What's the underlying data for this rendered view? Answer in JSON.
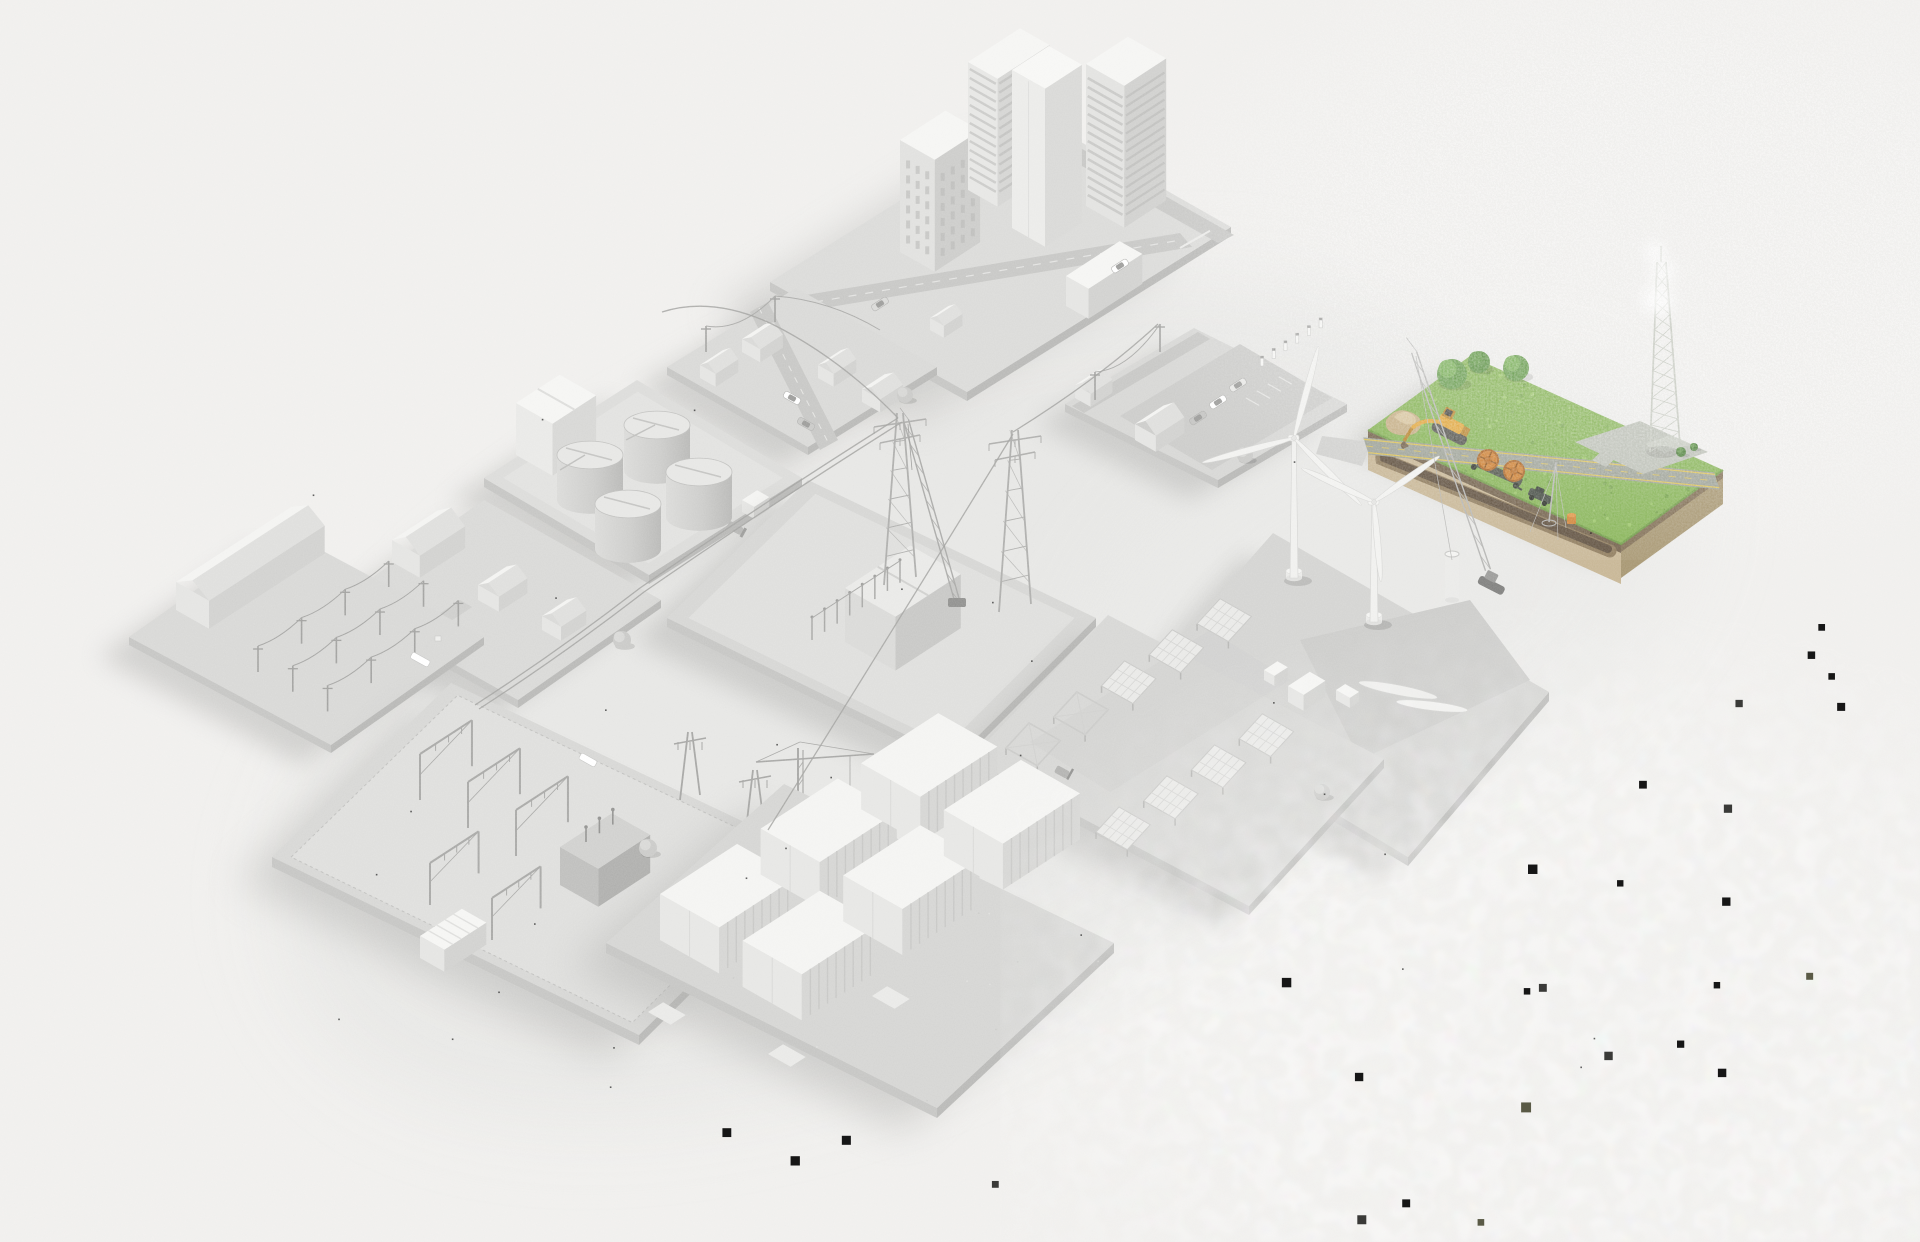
{
  "scene": {
    "title": "Isometric energy infrastructure illustration",
    "description": "3D isometric diorama of twelve city and energy tiles rendered in grayscale, with one highlighted green construction tile where an excavator digs an underground cable trench beside a country road and a lattice tower.",
    "width": 1920,
    "height": 1242
  },
  "palette": {
    "background": "#f0efed",
    "tile_top": "#d8d8d6",
    "tile_side": "#c4c4c2",
    "tile_side_dark": "#b7b7b5",
    "building_top": "#f5f5f3",
    "building_left": "#e4e4e2",
    "building_right": "#d0d0ce",
    "road_gray": "#c6c6c4",
    "steel_gray": "#acacaa",
    "shadow": "#a8a8a6",
    "grass": "#82b150",
    "grass_light": "#9cc868",
    "grass_dark": "#6a9a40",
    "soil_left": "#c6b492",
    "soil_right": "#a5946e",
    "soil_band": "#6e5c45",
    "trench_brown": "#5a4a38",
    "trench_edge": "#8b7757",
    "asphalt": "#999e93",
    "road_line_yellow": "#e0c24c",
    "concrete_pad": "#b9bdb3",
    "excavator_yellow": "#e0a335",
    "excavator_dark": "#b57f25",
    "tracks_gray": "#4c4c46",
    "reel_orange": "#cc7c2c",
    "reel_rim": "#a85f1d",
    "truck_green": "#3f463d",
    "barrel_orange": "#cf7e2e",
    "tree_green": "#5e9643",
    "tree_green_light": "#74ac52",
    "tree_gray": "#c9c9c7",
    "lattice_steel": "#c2c6bc",
    "artifact_black": "#161616"
  },
  "tiles": [
    {
      "id": "city",
      "name": "downtown district",
      "highlighted": false,
      "features": [
        "four high-rise buildings",
        "street grid",
        "cars"
      ]
    },
    {
      "id": "resN",
      "name": "residential street north",
      "highlighted": false,
      "features": [
        "four houses",
        "cars",
        "overhead distribution lines"
      ]
    },
    {
      "id": "tanks",
      "name": "fuel storage terminal",
      "highlighted": false,
      "features": [
        "four cylindrical storage tanks",
        "process building",
        "walkways"
      ]
    },
    {
      "id": "resW",
      "name": "residential street west",
      "highlighted": false,
      "features": [
        "farmhouse",
        "two houses",
        "trees"
      ]
    },
    {
      "id": "ware",
      "name": "utility pole training yard",
      "highlighted": false,
      "features": [
        "long warehouse",
        "rows of utility poles with wires",
        "bucket truck"
      ]
    },
    {
      "id": "sub",
      "name": "substation",
      "highlighted": false,
      "features": [
        "lattice gantries",
        "transformer",
        "control building",
        "tower crane",
        "dead-end towers"
      ]
    },
    {
      "id": "trans",
      "name": "transmission construction site",
      "highlighted": false,
      "features": [
        "two lattice pylons",
        "transformer hall",
        "bus bars",
        "crane",
        "pickup truck"
      ]
    },
    {
      "id": "ev",
      "name": "EV charging plaza",
      "highlighted": false,
      "features": [
        "row of charging posts",
        "parked cars",
        "parking stripes",
        "houses",
        "utility poles"
      ]
    },
    {
      "id": "green",
      "name": "rural cable construction site",
      "highlighted": true,
      "features": [
        "excavator digging a trench",
        "dirt pile",
        "cable reel trailer",
        "pickup truck",
        "country road with yellow lines",
        "concrete pad",
        "lattice tower",
        "trees",
        "orange barrel"
      ]
    },
    {
      "id": "wind",
      "name": "wind farm under construction",
      "highlighted": false,
      "features": [
        "two erected turbines",
        "partial tower",
        "crawler crane",
        "blades and nacelle on the ground",
        "guyed mast"
      ]
    },
    {
      "id": "solar",
      "name": "solar farm under construction",
      "highlighted": false,
      "features": [
        "two rows of tilted panels",
        "empty mounting racks",
        "inverter skids",
        "forklift"
      ]
    },
    {
      "id": "batt",
      "name": "battery storage yard",
      "highlighted": false,
      "features": [
        "six white container units",
        "concrete pads",
        "gravel ground"
      ]
    }
  ],
  "counts": {
    "charging_posts": 6,
    "storage_tanks": 4,
    "battery_container_rows": 2,
    "battery_container_cols": 3,
    "solar_row1_racks": 5,
    "solar_row1_empty": 2,
    "solar_row2_racks": 4,
    "wind_turbines_complete": 2,
    "wind_turbines_partial": 1,
    "cable_reels": 2,
    "green_tile_trees": 3,
    "warehouse_pole_rows": 3,
    "warehouse_pole_cols": 4
  },
  "noise": {
    "fine_opacity": 0.18,
    "patch_opacity": 0.55,
    "black_squares": 27,
    "grass_speckles": 80
  }
}
